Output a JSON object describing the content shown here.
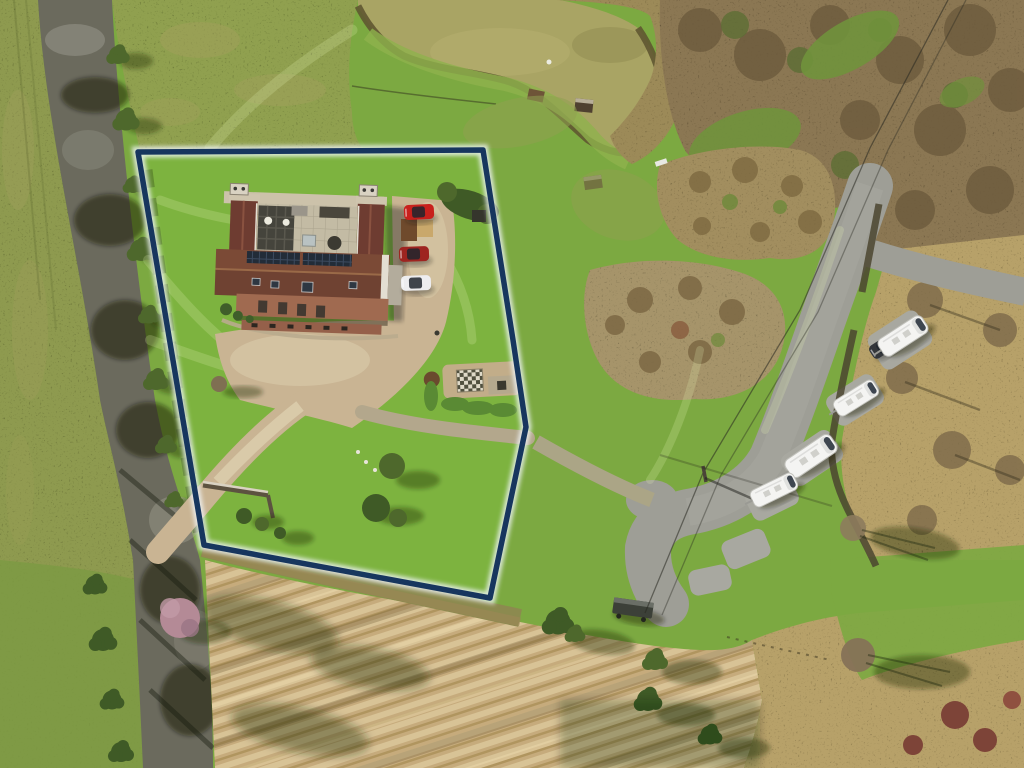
{
  "image": {
    "kind": "aerial-drone-photograph",
    "subject": "rural property with navy plot-boundary overlay, courtyard farmhouse with solar panels, fishing pond, country lane, caravan parking bays and ploughed field",
    "width": 1024,
    "height": 768
  },
  "colors": {
    "green-base": "#7ca941",
    "green-lawn": "#7db33f",
    "olive-field": "#8e9a4f",
    "olive-rough": "#90a050",
    "green-bottom": "#7d9a43",
    "lane": "#6b6a5d",
    "tarmac": "#9e9e96",
    "bay": "#a8a8a0",
    "gravel": "#c9b493",
    "gravel-light": "#ddd0af",
    "track": "#b3a78c",
    "water": "#a9a464",
    "reed": "#5f5731",
    "reed-mass": "#9c8a58",
    "wood1": "#8b7753",
    "wood2": "#6e5c3e",
    "wood-green": "#70923c",
    "scrub-a": "#a28e5e",
    "scrub-b": "#a6946a",
    "tan-rough": "#b7a169",
    "stubble1": "#c6ab7c",
    "stubble2": "#d8c396",
    "stubble3": "#b0955f",
    "boundary": "#17365e",
    "halo": "#f2f6fa",
    "roof-wing": "#6e3c31",
    "roof-main": "#7b4a36",
    "roof-main-dark": "#6f4232",
    "roof-front": "#a06a50",
    "court": "#c3bba4",
    "pergola": "#45443c",
    "solar": "#222c38",
    "cap": "#cfc5ae",
    "tree-green": "#4e682c",
    "tree-dark": "#3f5a26",
    "hedge-bright": "#5a8a34",
    "purple-tree": "#b48a96",
    "caravan-body": "#f4f4f2",
    "white-trim": "#e3ded2"
  },
  "scene": {
    "boundary": {
      "color": "#17365e",
      "halo": "#f2f6fa",
      "points": [
        [
          138,
          152
        ],
        [
          483,
          150
        ],
        [
          513,
          340
        ],
        [
          526,
          427
        ],
        [
          490,
          598
        ],
        [
          204,
          545
        ]
      ]
    },
    "pond": {
      "label": "fishing-pond"
    },
    "house": {
      "label": "courtyard-farmhouse-with-solar-panels"
    },
    "caravans": [
      {
        "x": 903,
        "y": 336,
        "angle": -33,
        "scale": 1
      },
      {
        "x": 856,
        "y": 398,
        "angle": -32,
        "scale": 0.9
      },
      {
        "x": 811,
        "y": 456,
        "angle": -34,
        "scale": 1.05
      },
      {
        "x": 774,
        "y": 490,
        "angle": -26,
        "scale": 0.92
      }
    ],
    "cars": [
      {
        "x": 419,
        "y": 212,
        "angle": -3,
        "color": "#c8201c"
      },
      {
        "x": 414,
        "y": 254,
        "angle": -2,
        "color": "#9e2420"
      },
      {
        "x": 416,
        "y": 283,
        "angle": -2,
        "color": "#ededef"
      },
      {
        "x": 884,
        "y": 346,
        "angle": -33,
        "color": "#33363a"
      }
    ]
  }
}
